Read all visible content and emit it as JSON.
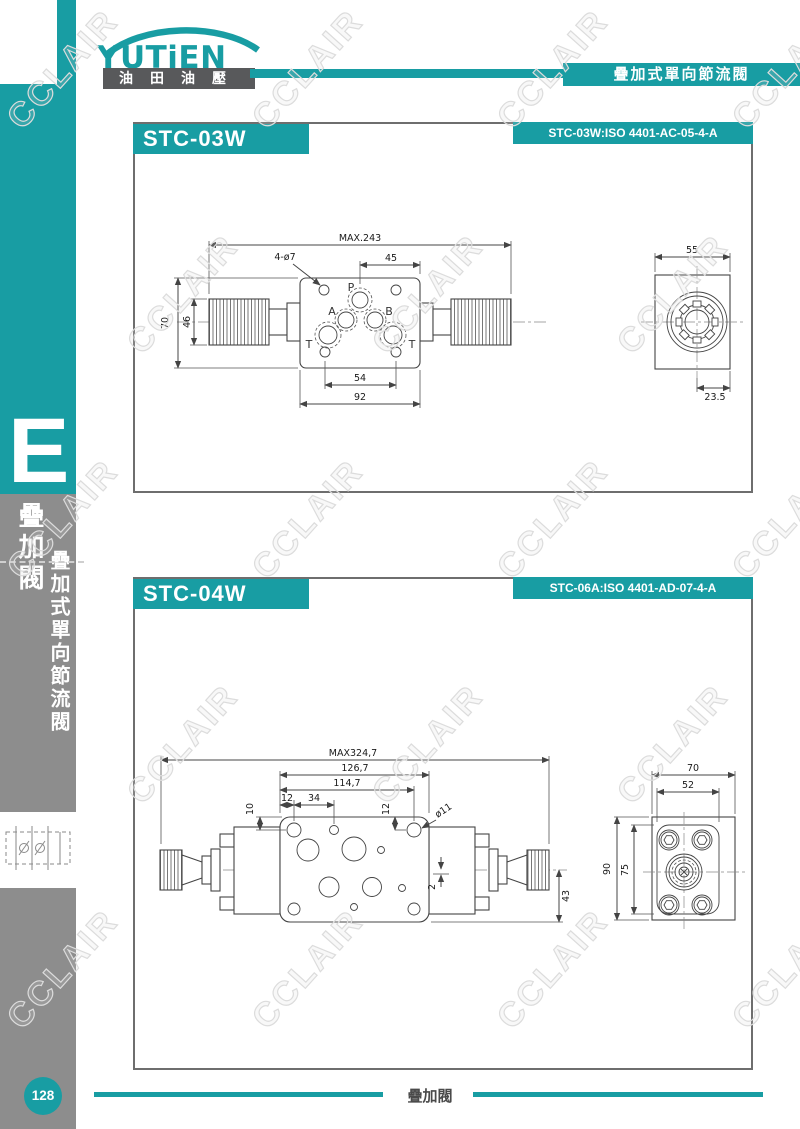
{
  "page": {
    "watermark": "CCLAIR",
    "colors": {
      "teal": "#189DA3",
      "sidebar_gray": "#8D8D8D"
    }
  },
  "brand": {
    "logo": "YUTiEN",
    "logo_sub": "油田油壓"
  },
  "header": {
    "product_title": "疊加式單向節流閥"
  },
  "sidebar": {
    "section_letter": "E",
    "category": "疊加閥",
    "subcategory": "疊加式單向節流閥",
    "page_number": "128"
  },
  "footer": {
    "label": "疊加閥"
  },
  "sections": [
    {
      "model": "STC-03W",
      "iso_code": "STC-03W:ISO 4401-AC-05-4-A",
      "ports": {
        "p": "P",
        "a": "A",
        "b": "B",
        "t_left": "T",
        "t_right": "T"
      },
      "dims": {
        "overall_length": "MAX.243",
        "port_offset": "45",
        "mount_holes": "4-ø7",
        "overall_height": "70",
        "knob_height": "46",
        "bolt_span": "54",
        "body_width": "92",
        "end_width": "55",
        "end_offset": "23.5"
      }
    },
    {
      "model": "STC-04W",
      "iso_code": "STC-06A:ISO 4401-AD-07-4-A",
      "dims": {
        "overall_length": "MAX324,7",
        "plate_width": "126,7",
        "hole_span": "114,7",
        "edge_to_hole": "12",
        "hole_pitch": "34",
        "top_offset": "10",
        "hole_offset": "12",
        "hole_dia": "ø11",
        "center_offset": "2",
        "bottom_height": "43",
        "end_width": "70",
        "end_bolt_span": "52",
        "end_height": "90",
        "end_bolt_vspan": "75"
      }
    }
  ]
}
